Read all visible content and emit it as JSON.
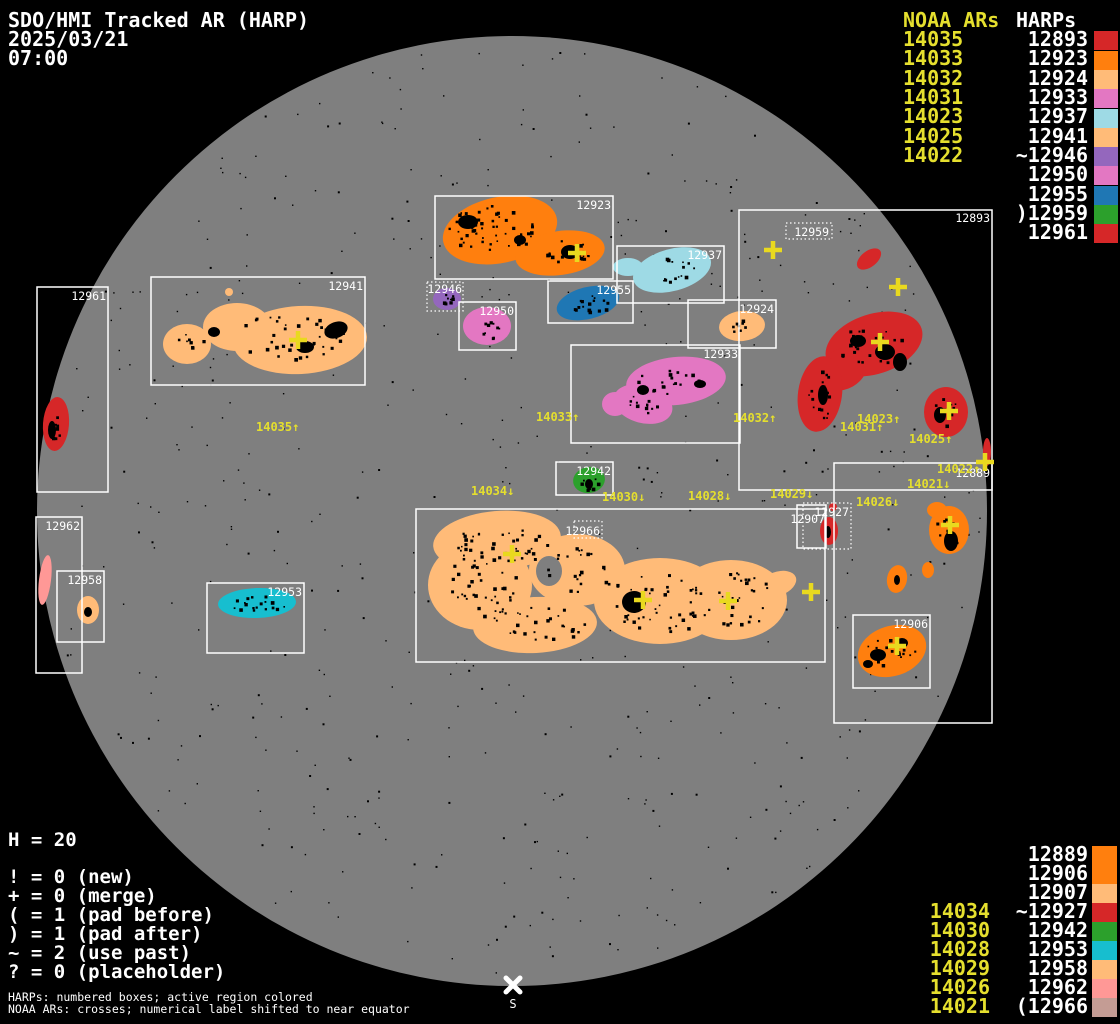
{
  "header": {
    "title": "SDO/HMI Tracked AR (HARP)",
    "date": "2025/03/21",
    "time": "07:00"
  },
  "columns_top": {
    "noaa_header": "NOAA ARs",
    "harps_header": "HARPs",
    "noaa": [
      "14035",
      "14033",
      "14032",
      "14031",
      "14023",
      "14025",
      "14022"
    ],
    "harps": [
      {
        "label": "12893",
        "color": "#d62728"
      },
      {
        "label": "12923",
        "color": "#ff7f0e"
      },
      {
        "label": "12924",
        "color": "#ffbb78"
      },
      {
        "label": "12933",
        "color": "#e377c2"
      },
      {
        "label": "12937",
        "color": "#9edae5"
      },
      {
        "label": "12941",
        "color": "#ffbb78"
      },
      {
        "label": "~12946",
        "color": "#9467bd"
      },
      {
        "label": "12950",
        "color": "#e377c2"
      },
      {
        "label": "12955",
        "color": "#1f77b4"
      },
      {
        "label": ")12959",
        "color": "#2ca02c"
      },
      {
        "label": "12961",
        "color": "#d62728"
      }
    ]
  },
  "columns_bottom": {
    "noaa": [
      "14034",
      "14030",
      "14028",
      "14029",
      "14026",
      "14021"
    ],
    "harps": [
      {
        "label": "12889",
        "color": "#ff7f0e"
      },
      {
        "label": "12906",
        "color": "#ff7f0e"
      },
      {
        "label": "12907",
        "color": "#ffbb78"
      },
      {
        "label": "~12927",
        "color": "#d62728"
      },
      {
        "label": "12942",
        "color": "#2ca02c"
      },
      {
        "label": "12953",
        "color": "#17becf"
      },
      {
        "label": "12958",
        "color": "#ffbb78"
      },
      {
        "label": "12962",
        "color": "#ff9896"
      },
      {
        "label": "(12966",
        "color": "#c49c94"
      }
    ]
  },
  "legend": {
    "h_count": "H = 20",
    "items": [
      "! = 0 (new)",
      "+ = 0 (merge)",
      "( = 1 (pad before)",
      ") = 1 (pad after)",
      "~ = 2 (use past)",
      "? = 0 (placeholder)"
    ]
  },
  "footer": {
    "line1": "HARPs: numbered boxes; active region colored",
    "line2": "NOAA ARs: crosses; numerical label shifted to near equator"
  },
  "south_label": "S",
  "colors": {
    "12889": "#ff7f0e",
    "12893": "#d62728",
    "12906": "#ff7f0e",
    "12907": "#ffbb78",
    "12923": "#ff7f0e",
    "12924": "#ffbb78",
    "12927": "#d62728",
    "12933": "#e377c2",
    "12937": "#9edae5",
    "12941": "#ffbb78",
    "12942": "#2ca02c",
    "12946": "#9467bd",
    "12950": "#e377c2",
    "12953": "#17becf",
    "12955": "#1f77b4",
    "12958": "#ffbb78",
    "12961": "#d62728",
    "12962": "#ff9896",
    "12966": "#ffbb78"
  },
  "box_labels": {
    "b12889": "12889",
    "b12893": "12893",
    "b12906": "12906",
    "b12907": "12907",
    "b12923": "12923",
    "b12924": "12924",
    "b12927": "12927",
    "b12933": "12933",
    "b12937": "12937",
    "b12941": "12941",
    "b12942": "12942",
    "b12946": "12946",
    "b12950": "12950",
    "b12953": "12953",
    "b12955": "12955",
    "b12958": "12958",
    "b12959": "12959",
    "b12961": "12961",
    "b12962": "12962",
    "b12966": "12966"
  },
  "ar_labels": {
    "a14035": "14035↑",
    "a14033": "14033↑",
    "a14032": "14032↑",
    "a14031": "14031↑",
    "a14023": "14023↑",
    "a14025": "14025↑",
    "a14022": "14022↑",
    "a14034": "14034↓",
    "a14030": "14030↓",
    "a14028": "14028↓",
    "a14029": "14029↓",
    "a14026": "14026↓",
    "a14021": "14021↓"
  }
}
